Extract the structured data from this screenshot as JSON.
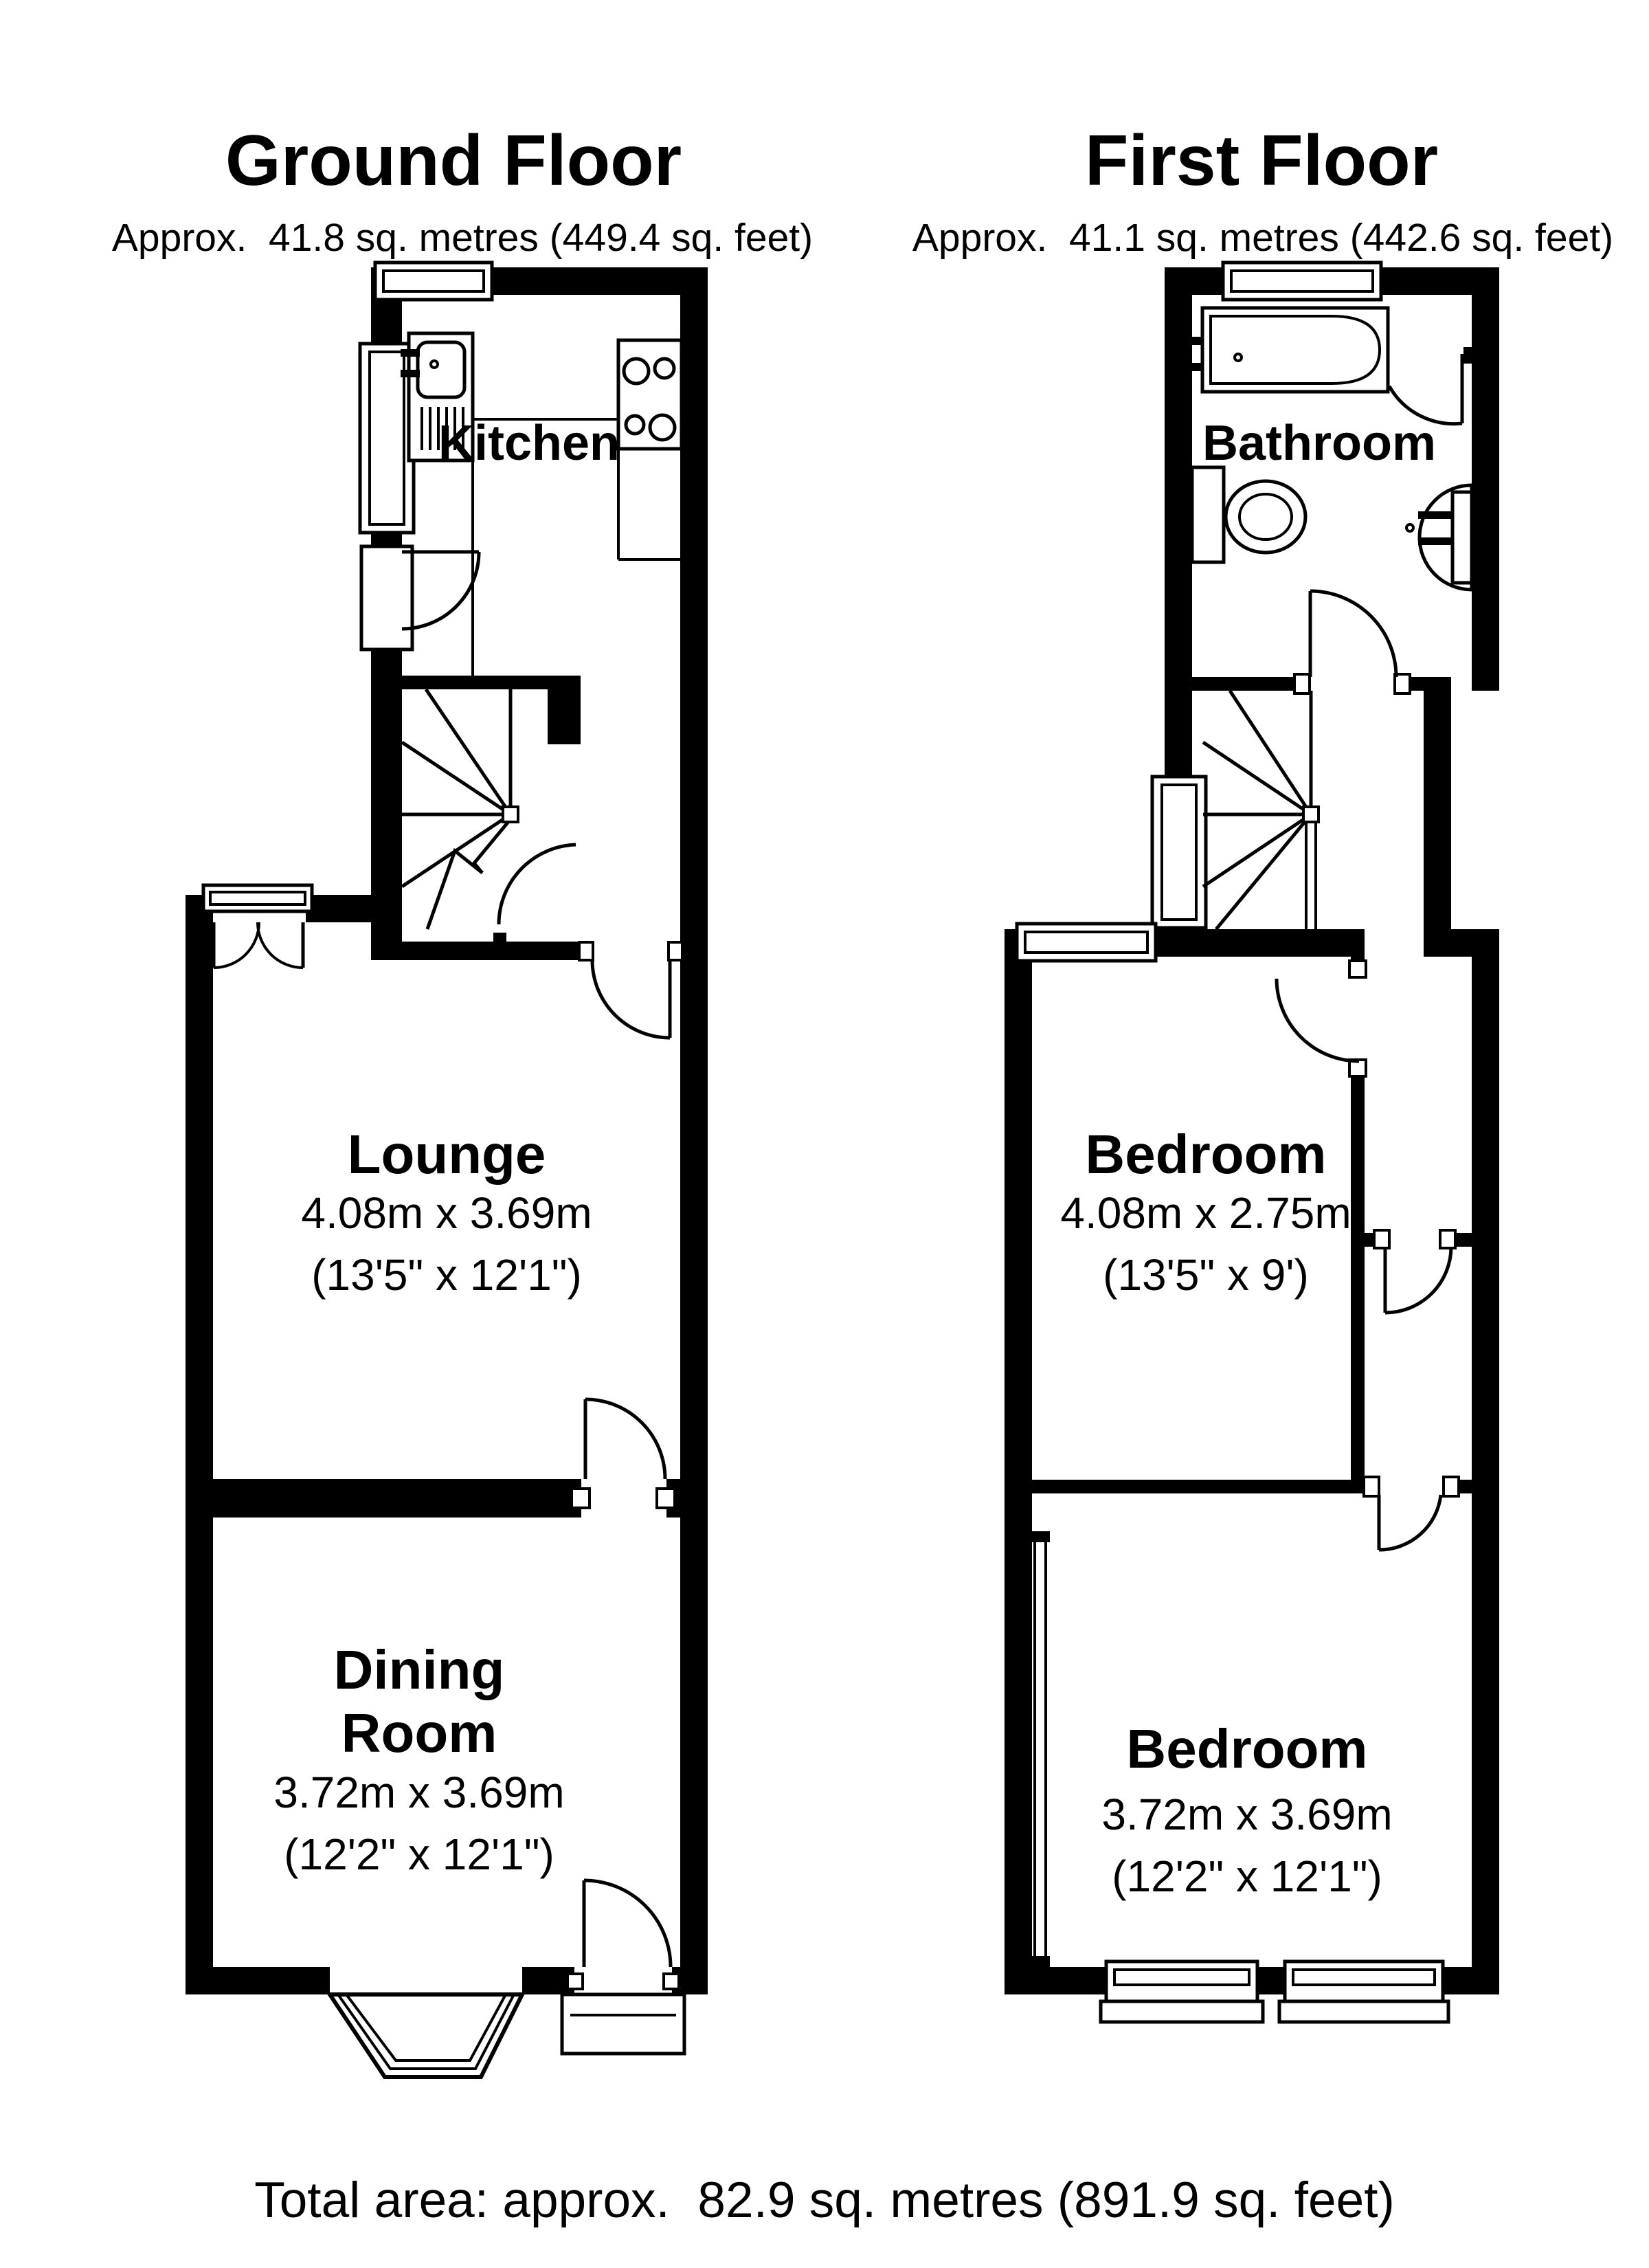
{
  "colors": {
    "ink": "#000000",
    "background": "#ffffff"
  },
  "floors": [
    {
      "id": "ground-floor",
      "title": "Ground Floor",
      "area": "Approx.  41.8 sq. metres (449.4 sq. feet)",
      "rooms": [
        {
          "id": "kitchen",
          "name": "Kitchen"
        },
        {
          "id": "lounge",
          "name": "Lounge",
          "dims_metric": "4.08m x 3.69m",
          "dims_imperial": "(13'5\" x 12'1\")"
        },
        {
          "id": "dining-room",
          "name_line1": "Dining",
          "name_line2": "Room",
          "dims_metric": "3.72m x 3.69m",
          "dims_imperial": "(12'2\" x 12'1\")"
        }
      ]
    },
    {
      "id": "first-floor",
      "title": "First Floor",
      "area": "Approx.  41.1 sq. metres (442.6 sq. feet)",
      "rooms": [
        {
          "id": "bathroom",
          "name": "Bathroom"
        },
        {
          "id": "bedroom-1",
          "name": "Bedroom",
          "dims_metric": "4.08m x 2.75m",
          "dims_imperial": "(13'5\" x 9')"
        },
        {
          "id": "bedroom-2",
          "name": "Bedroom",
          "dims_metric": "3.72m x 3.69m",
          "dims_imperial": "(12'2\" x 12'1\")"
        }
      ]
    }
  ],
  "total_area": "Total area: approx.  82.9 sq. metres (891.9 sq. feet)"
}
